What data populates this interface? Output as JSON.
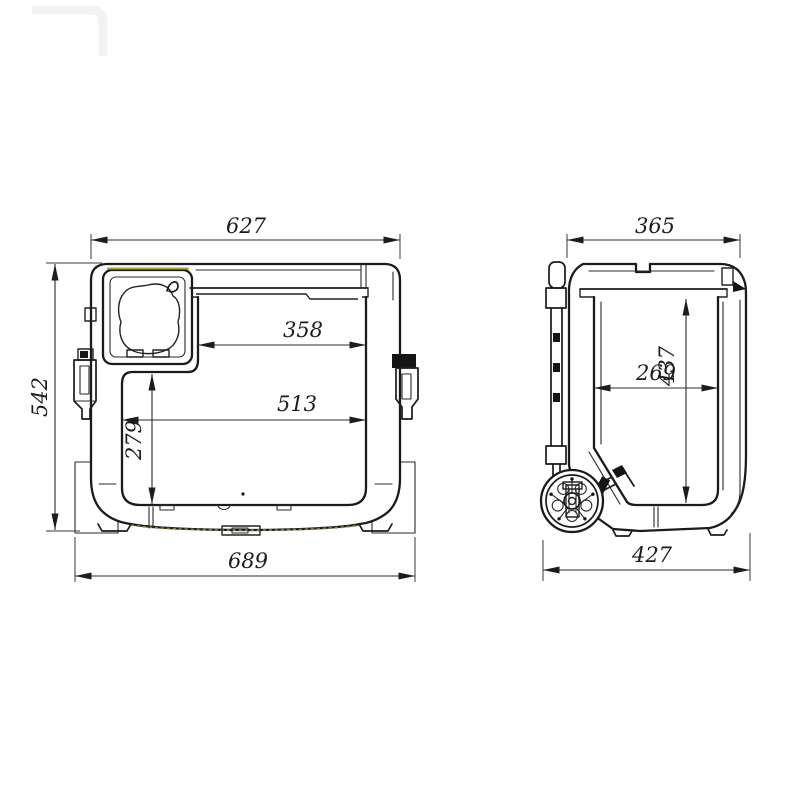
{
  "drawing": {
    "title": "trolley-cooler-dimension-drawing",
    "colors": {
      "line": "#1b1b1b",
      "gasket_accent": "#8f7f36"
    },
    "views": {
      "front": {
        "name": "front section view",
        "dims": {
          "top_width": "627",
          "overall_height": "542",
          "opening_width": "358",
          "interior_width": "513",
          "left_cavity_height": "279",
          "base_width": "689"
        }
      },
      "side": {
        "name": "side section view",
        "dims": {
          "top_depth": "365",
          "interior_height": "437",
          "interior_depth": "269",
          "base_depth": "427"
        }
      }
    }
  }
}
